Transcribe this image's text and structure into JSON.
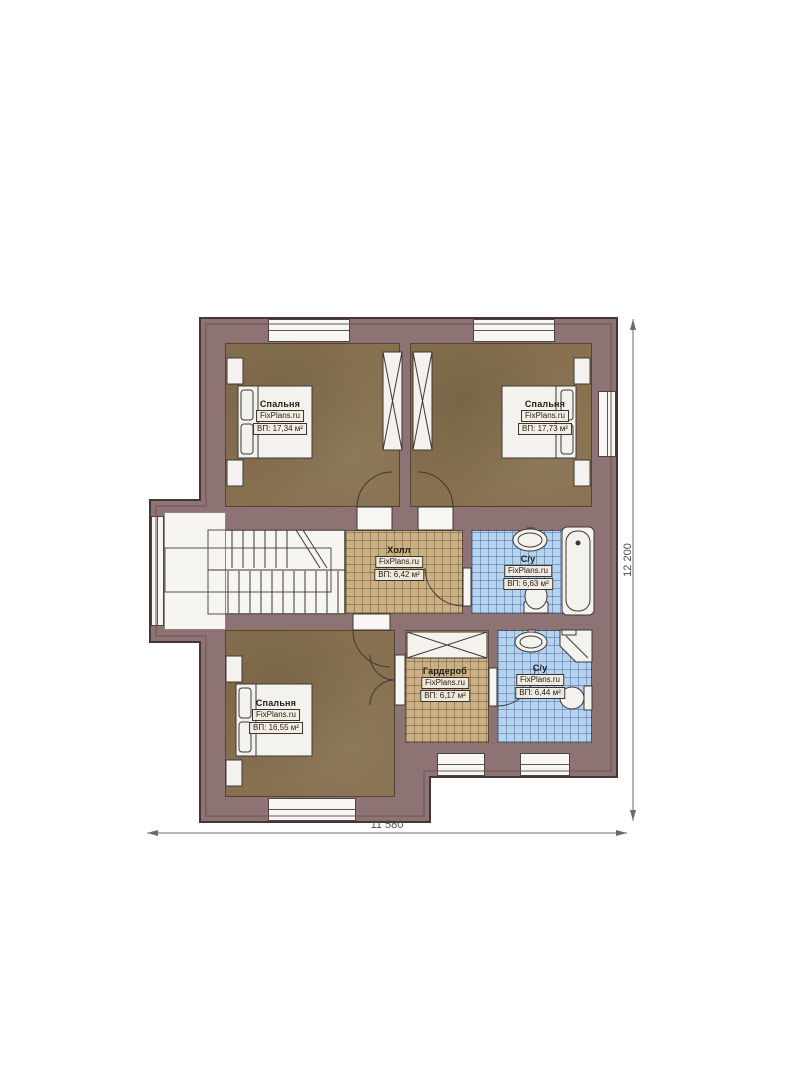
{
  "plan": {
    "rooms": [
      {
        "name": "Спальня",
        "brand": "FixPlans.ru",
        "area": "ВП: 17,34 м²"
      },
      {
        "name": "Спальня",
        "brand": "FixPlans.ru",
        "area": "ВП: 17,73 м²"
      },
      {
        "name": "Холл",
        "brand": "FixPlans.ru",
        "area": "ВП: 6,42 м²"
      },
      {
        "name": "С/у",
        "brand": "FixPlans.ru",
        "area": "ВП: 6,63 м²"
      },
      {
        "name": "Гардероб",
        "brand": "FixPlans.ru",
        "area": "ВП: 6,17 м²"
      },
      {
        "name": "С/у",
        "brand": "FixPlans.ru",
        "area": "ВП: 6,44 м²"
      },
      {
        "name": "Спальня",
        "brand": "FixPlans.ru",
        "area": "ВП: 16,55 м²"
      }
    ],
    "dimensions": {
      "width": "11 580",
      "height": "12 200"
    },
    "colors": {
      "wall": "#8d7373",
      "wood_floor": "#877050",
      "tile_beige": "#cbb083",
      "tile_blue": "#b5d2ee",
      "outline": "#463636"
    }
  }
}
